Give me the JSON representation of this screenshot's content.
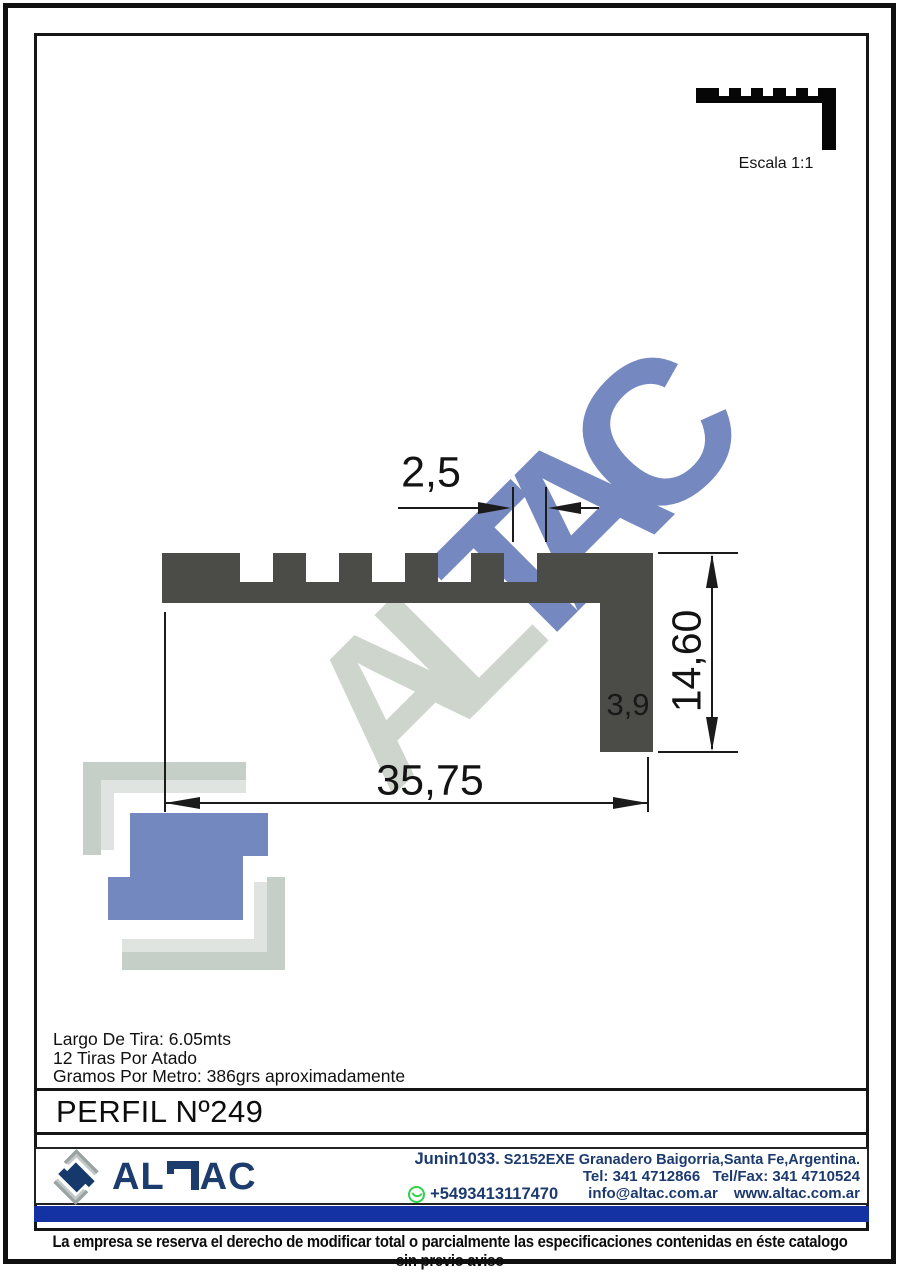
{
  "scale": {
    "label": "Escala 1:1"
  },
  "drawing": {
    "dim_tooth_width": "2,5",
    "dim_total_width": "35,75",
    "dim_height": "14,60",
    "dim_thickness": "3,9"
  },
  "watermark": {
    "gray_part": "AL",
    "blue_part": "TAC"
  },
  "specs": {
    "lines": [
      "Largo De Tira: 6.05mts",
      "12 Tiras Por Atado",
      "Gramos Por Metro: 386grs aproximadamente"
    ]
  },
  "title": "PERFIL Nº249",
  "footer": {
    "brand_al": "AL",
    "brand_ac": "AC",
    "address_big": "Junin1033.",
    "address_rest": " S2152EXE Granadero Baigorria,Santa Fe,Argentina.",
    "phones": "Tel: 341 4712866   Tel/Fax: 341 4710524",
    "whatsapp_number": "+5493413117470",
    "email": "info@altac.com.ar",
    "website": "www.altac.com.ar"
  },
  "disclaimer": "La empresa se reserva el derecho de modificar total o parcialmente las especificaciones contenidas en éste catalogo sin previo aviso",
  "colors": {
    "profile_gray": "#4b4b47",
    "watermark_gray": "#cdd5cd",
    "watermark_blue": "#7589c0",
    "brand_navy": "#1d3c6e",
    "bar_blue": "#1432a4",
    "whatsapp_green": "#31d14c",
    "logo_bracket_gray": "#c6cfc7",
    "logo_bracket_light": "#e0e4e0"
  }
}
